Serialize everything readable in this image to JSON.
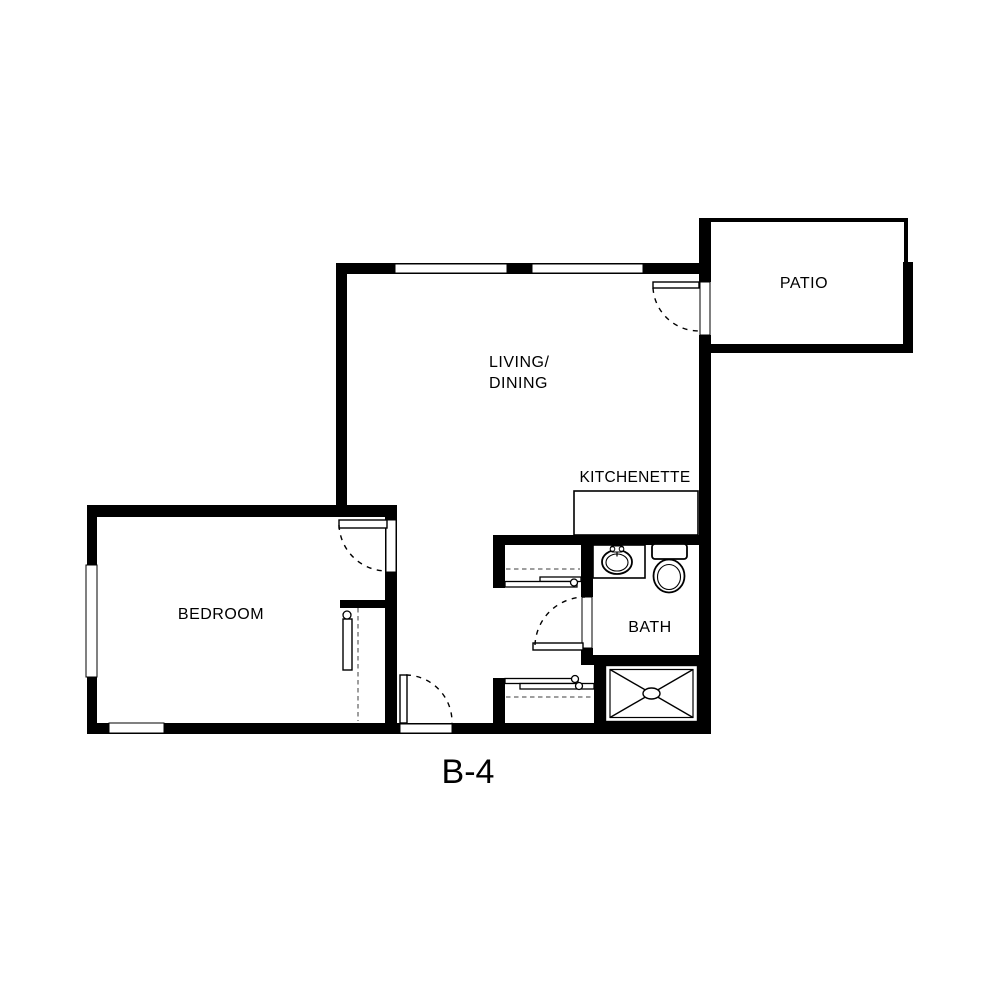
{
  "plan": {
    "title": "B-4",
    "labels": {
      "living_line1": "LIVING/",
      "living_line2": "DINING",
      "bedroom": "BEDROOM",
      "kitchenette": "KITCHENETTE",
      "bath": "BATH",
      "patio": "PATIO"
    },
    "colors": {
      "background": "#ffffff",
      "walls": "#000000",
      "closet_dash": "#7f7f7f",
      "text": "#000000"
    }
  }
}
